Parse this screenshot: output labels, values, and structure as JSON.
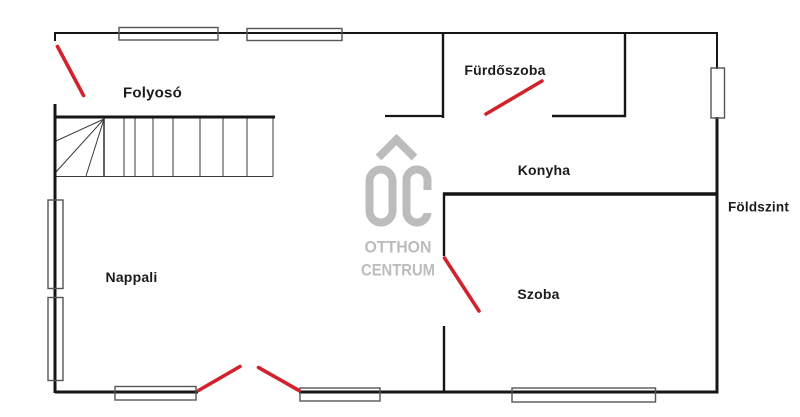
{
  "colors": {
    "wall_black": "#161616",
    "door_red": "#d2232d",
    "watermark_gray": "#bcbcbc",
    "window_outline": "#555555",
    "label_text": "#1c1c1c"
  },
  "rooms": {
    "folyoso": "Folyosó",
    "furdoszoba": "Fürdőszoba",
    "konyha": "Konyha",
    "nappali": "Nappali",
    "szoba": "Szoba"
  },
  "floor_label": "Földszint",
  "watermark": {
    "monogram": "OC",
    "line1": "OTTHON",
    "line2": "CENTRUM"
  }
}
